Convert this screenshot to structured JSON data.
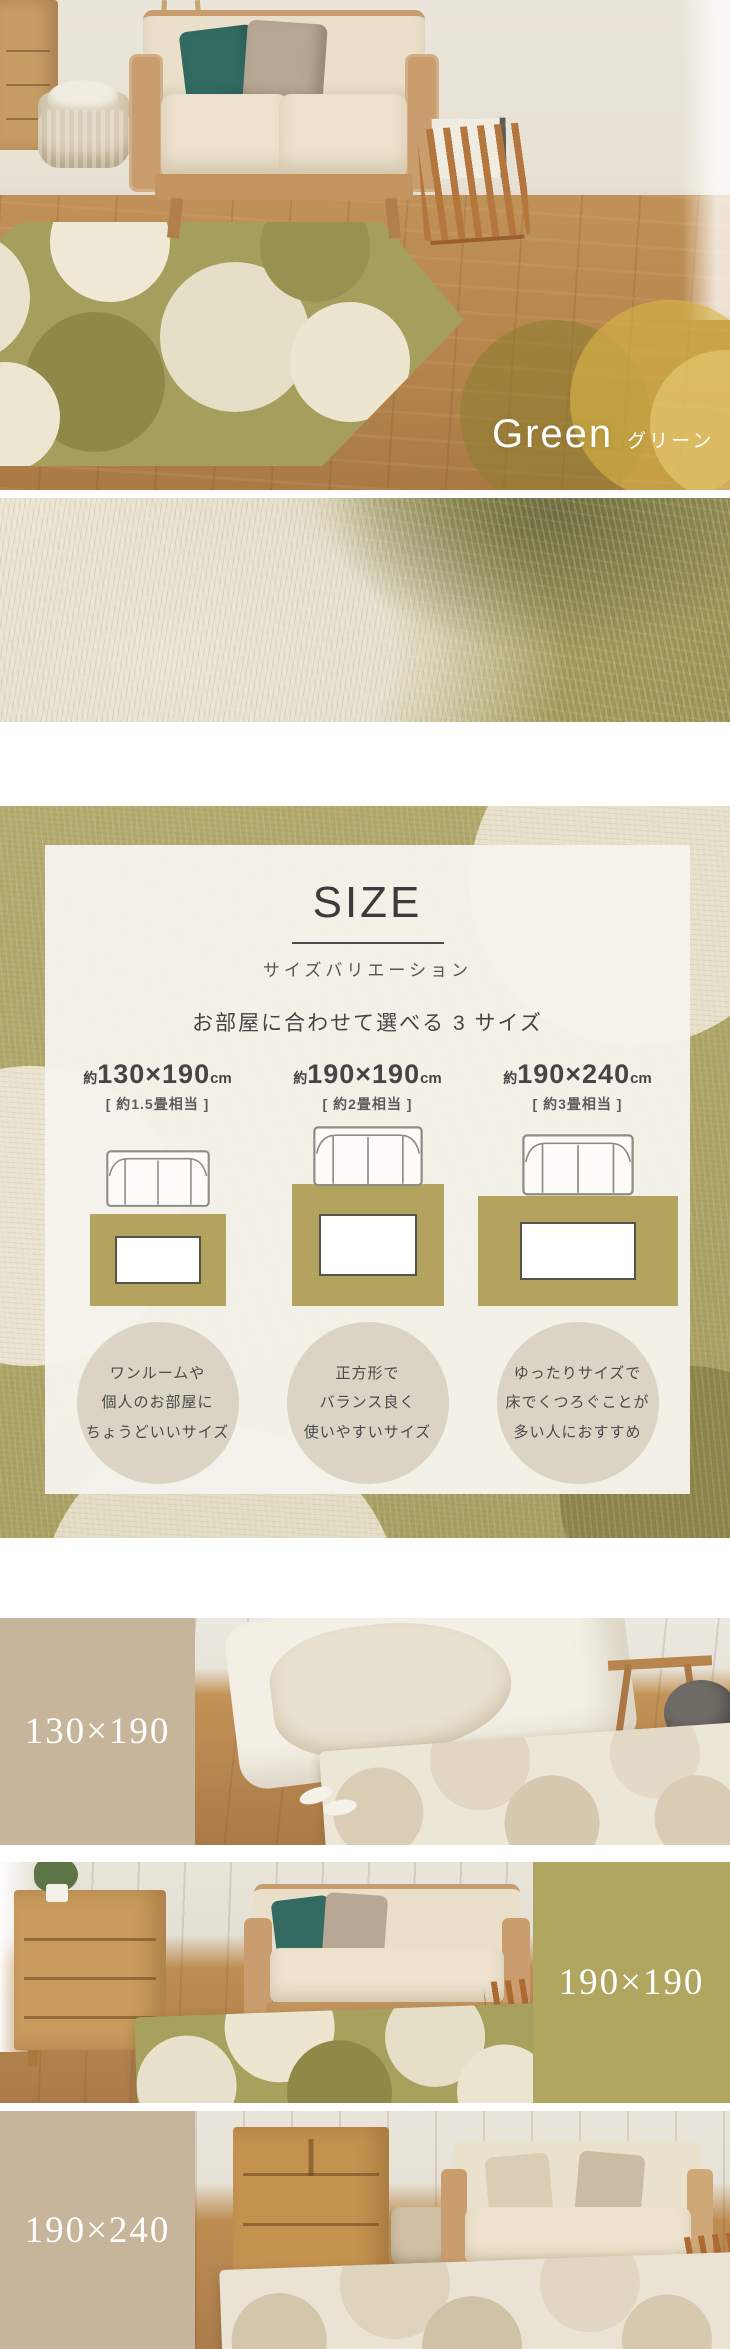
{
  "hero": {
    "color_en": "Green",
    "color_jp": "グリーン"
  },
  "size_section": {
    "title": "SIZE",
    "subtitle": "サイズバリエーション",
    "lead": "お部屋に合わせて選べる 3 サイズ",
    "sizes": [
      {
        "prefix": "約",
        "dims": "130×190",
        "unit": "cm",
        "tatami": "[ 約1.5畳相当 ]",
        "desc": [
          "ワンルームや",
          "個人のお部屋に",
          "ちょうどいいサイズ"
        ]
      },
      {
        "prefix": "約",
        "dims": "190×190",
        "unit": "cm",
        "tatami": "[ 約2畳相当 ]",
        "desc": [
          "正方形で",
          "バランス良く",
          "使いやすいサイズ"
        ]
      },
      {
        "prefix": "約",
        "dims": "190×240",
        "unit": "cm",
        "tatami": "[ 約3畳相当 ]",
        "desc": [
          "ゆったりサイズで",
          "床でくつろぐことが",
          "多い人におすすめ"
        ]
      }
    ]
  },
  "size_rows": [
    {
      "label": "130×190"
    },
    {
      "label": "190×190"
    },
    {
      "label": "190×240"
    }
  ],
  "icons": {
    "sofa_topview": "sofa-top-view-icon"
  },
  "colors": {
    "accent_olive": "#b1a65f",
    "accent_beige": "#c6b49b",
    "diagram_rug_tan": "#b3a35f",
    "panel_cream": "#f5f3eb",
    "text_dark": "#3b3b3b",
    "label_text": "#ffffff",
    "pillow_teal": "#336b62",
    "pillow_greige": "#b7a896"
  }
}
